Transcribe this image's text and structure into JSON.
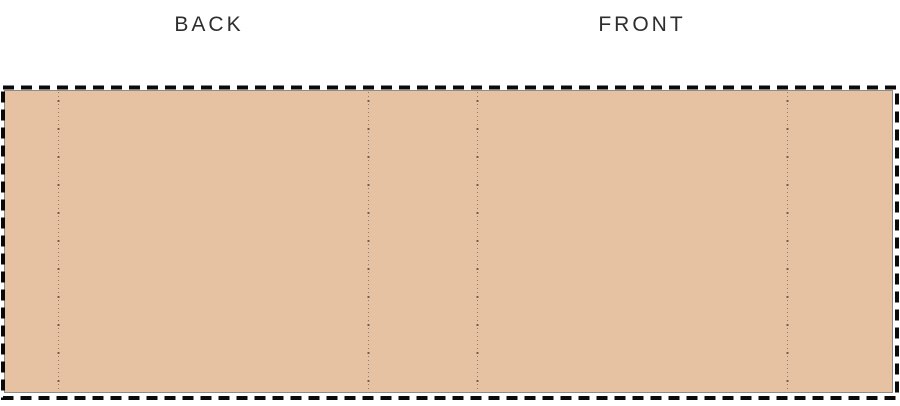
{
  "diagram": {
    "type": "package-dieline-template",
    "labels": {
      "back": "BACK",
      "front": "FRONT"
    },
    "colors": {
      "panel_fill": "#e6c2a2",
      "panel_outline": "#8c8c8c",
      "cut_border": "#0a0a0a",
      "fold_line": "#8d7c6e",
      "label_text": "#2e2e2e"
    },
    "fold_line_count": 4,
    "panels_visible": 5
  }
}
